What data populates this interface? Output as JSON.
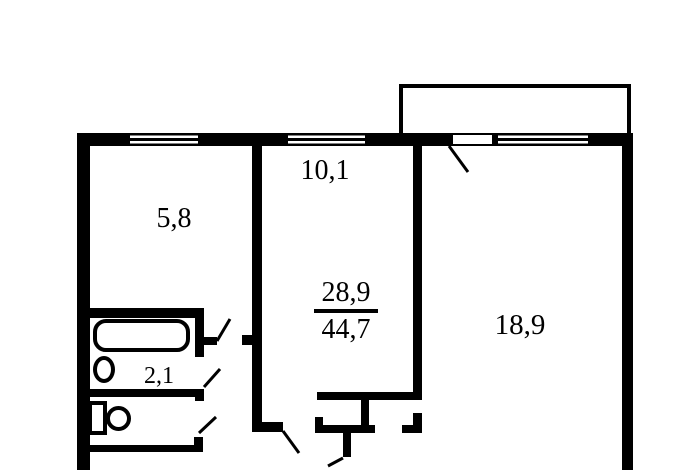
{
  "colors": {
    "background": "#ffffff",
    "line": "#000000"
  },
  "rooms": {
    "top_left": {
      "area": "5,8"
    },
    "top_middle": {
      "area": "10,1"
    },
    "hall": {
      "numerator": "28,9",
      "denominator": "44,7"
    },
    "right": {
      "area": "18,9"
    },
    "bathroom": {
      "area": "2,1"
    }
  }
}
